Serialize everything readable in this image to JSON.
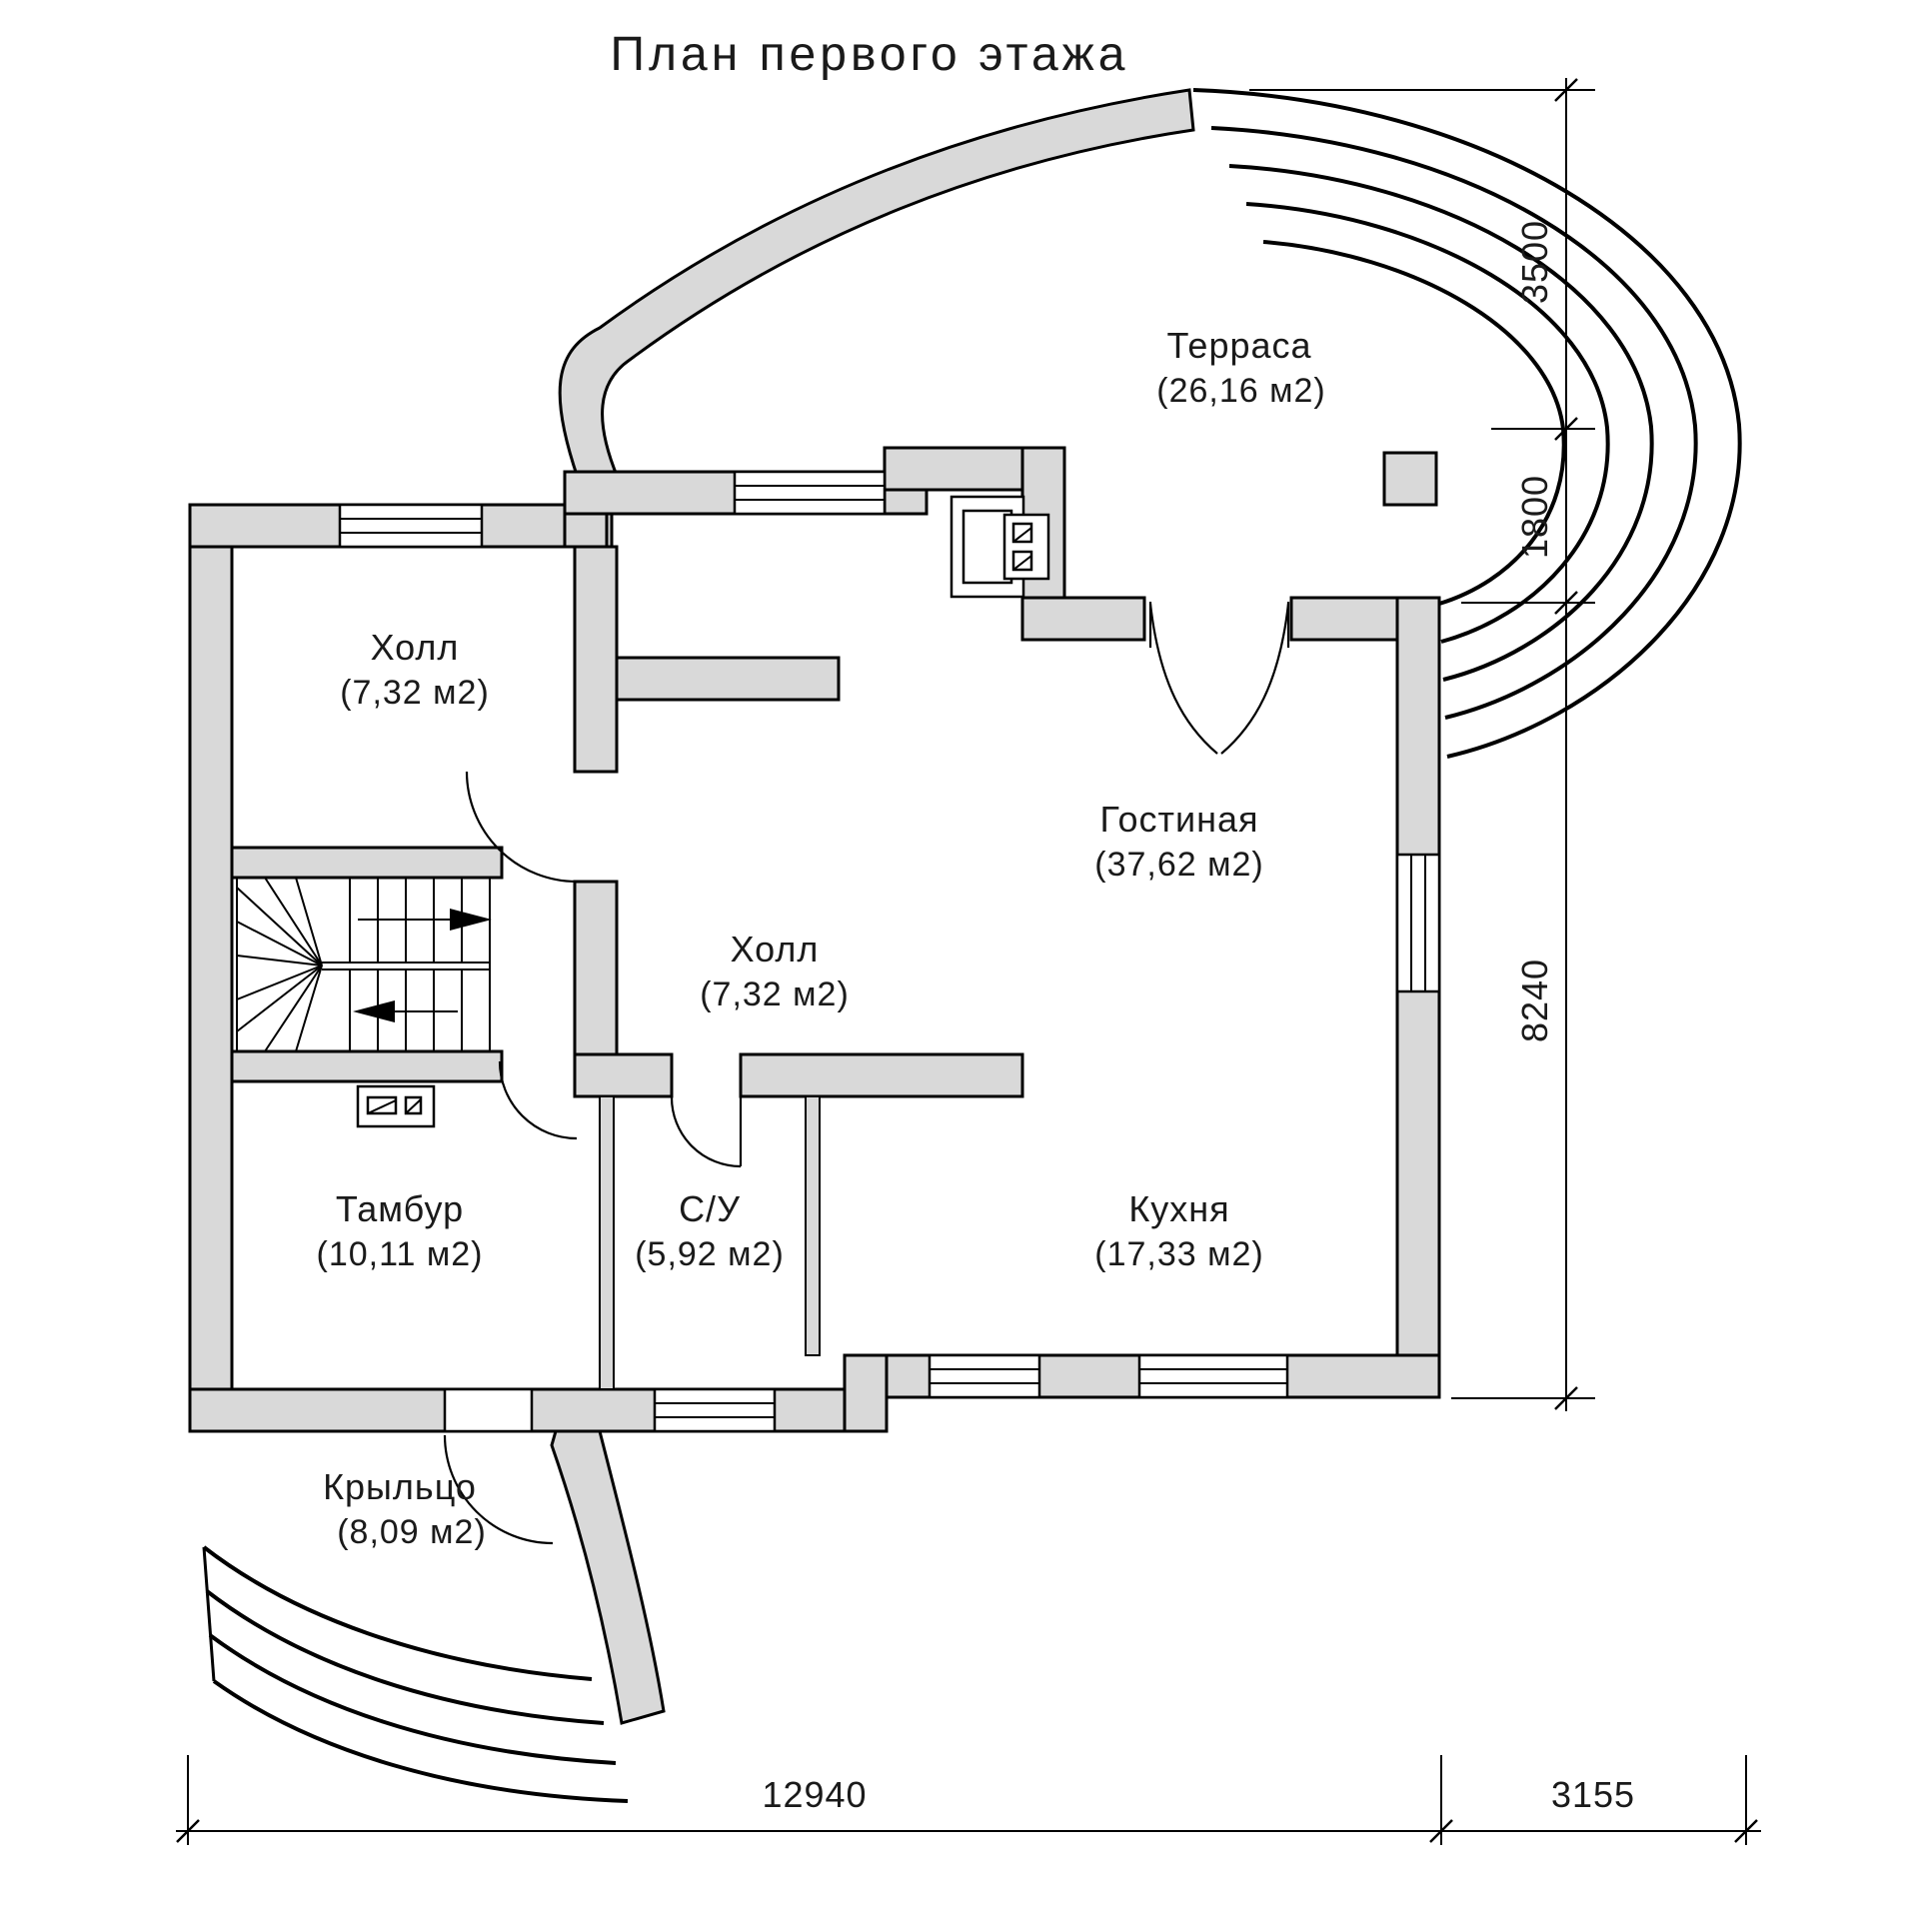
{
  "title": "План первого этажа",
  "rooms": {
    "terrace": {
      "name": "Терраса",
      "area": "(26,16 м2)"
    },
    "hall_upper": {
      "name": "Холл",
      "area": "(7,32 м2)"
    },
    "living": {
      "name": "Гостиная",
      "area": "(37,62 м2)"
    },
    "hall_center": {
      "name": "Холл",
      "area": "(7,32 м2)"
    },
    "tambour": {
      "name": "Тамбур",
      "area": "(10,11 м2)"
    },
    "wc": {
      "name": "С/У",
      "area": "(5,92 м2)"
    },
    "kitchen": {
      "name": "Кухня",
      "area": "(17,33 м2)"
    },
    "porch": {
      "name": "Крыльцо",
      "area": "(8,09 м2)"
    }
  },
  "dimensions": {
    "right_top": "3500",
    "right_middle": "1800",
    "right_bottom": "8240",
    "bottom_main": "12940",
    "bottom_terrace": "3155"
  },
  "colors": {
    "wall_fill": "#d9d9d9",
    "line": "#000000",
    "background": "#ffffff",
    "text": "#1a1a1a"
  }
}
